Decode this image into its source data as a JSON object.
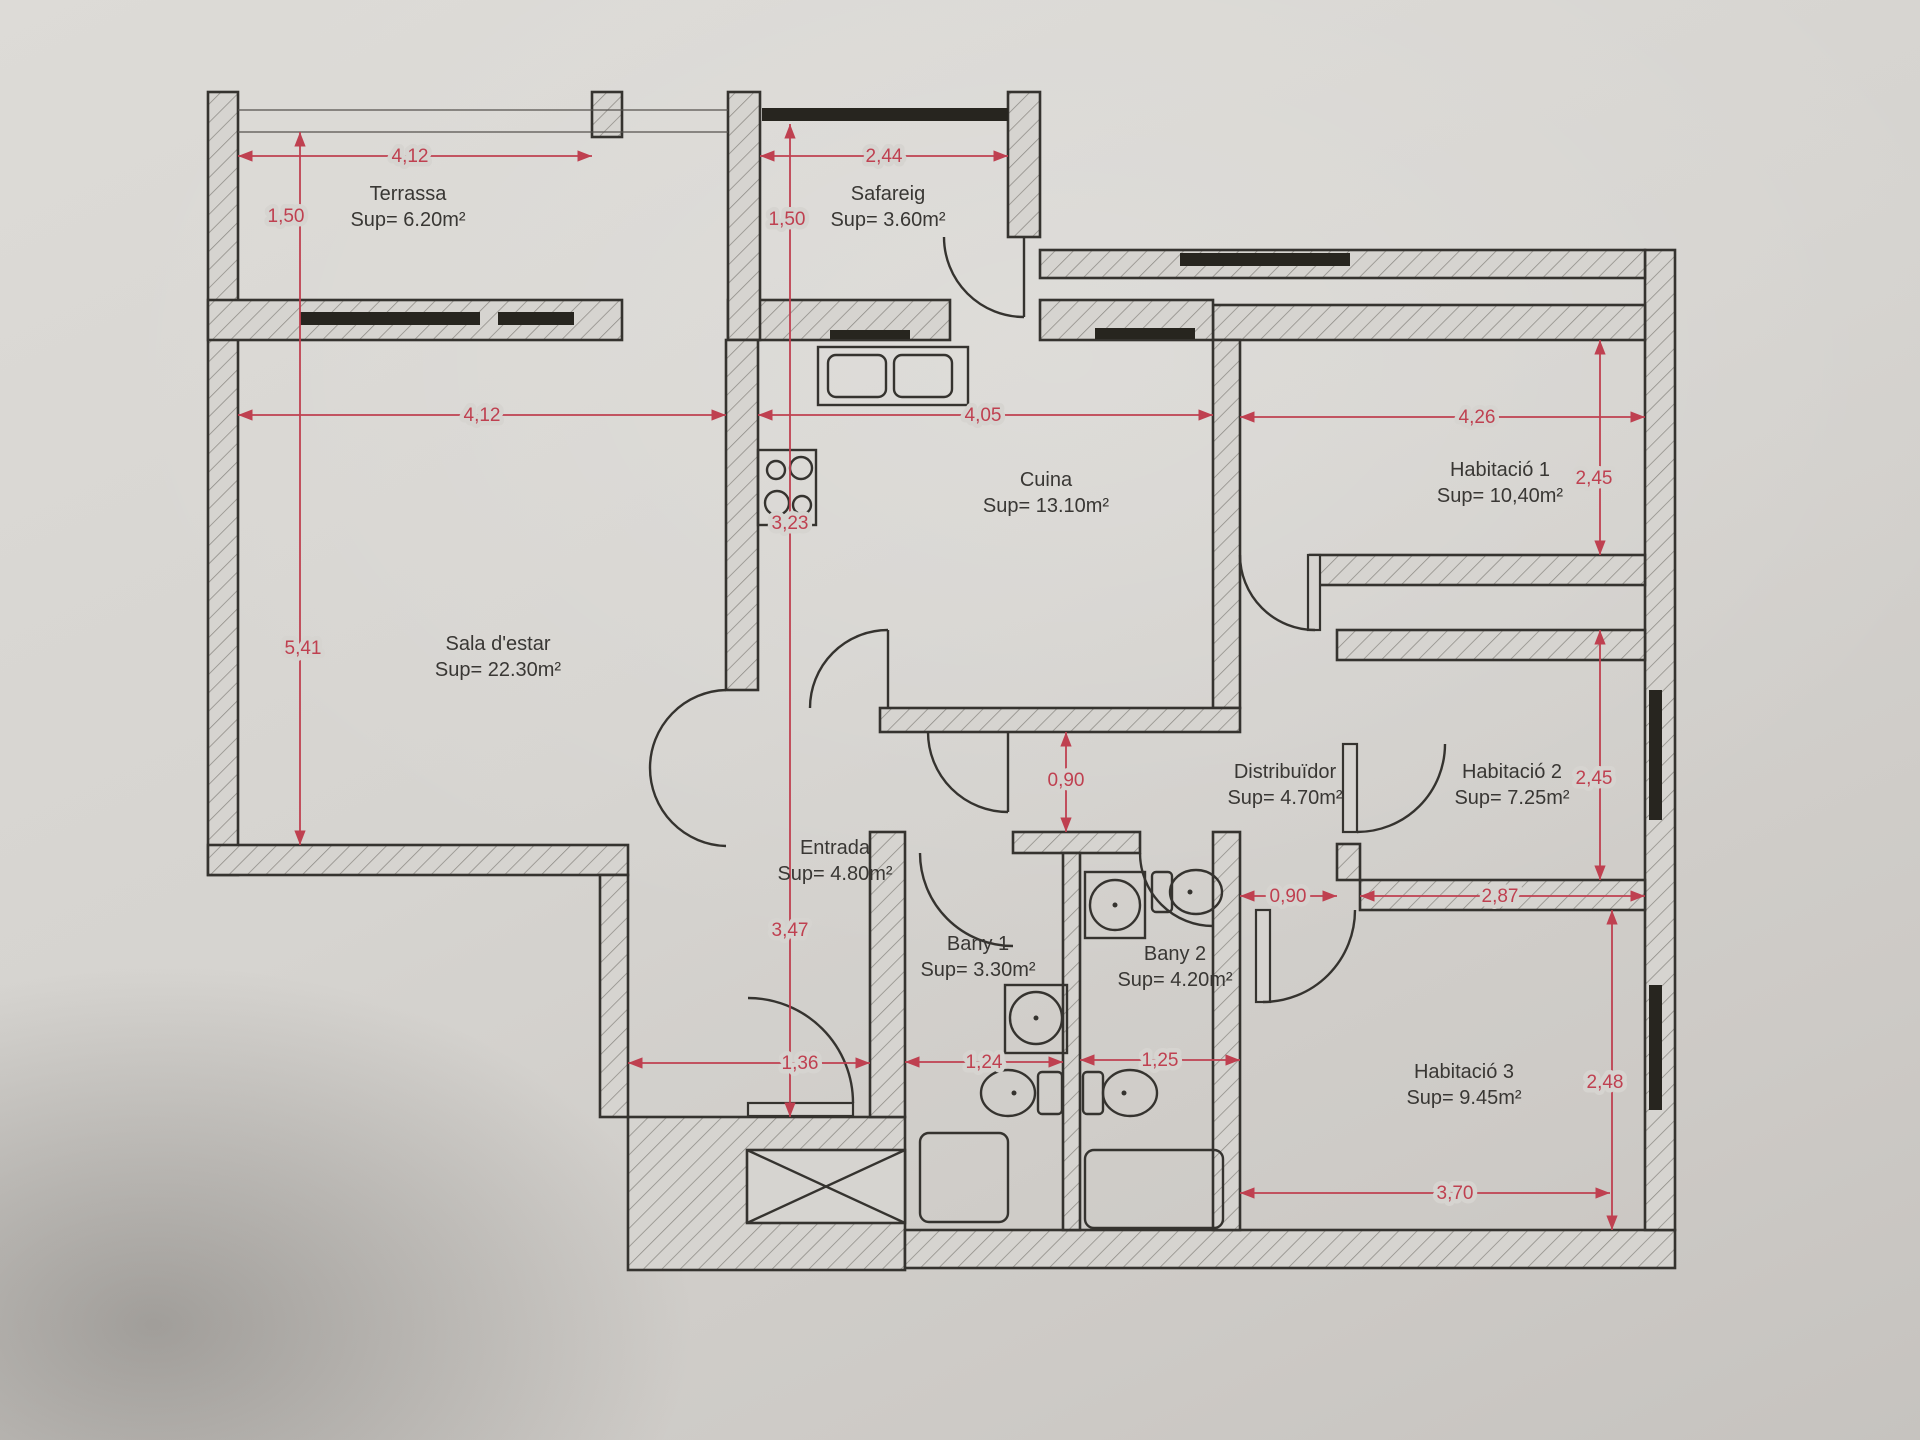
{
  "plan": {
    "rooms": {
      "terrassa": {
        "name": "Terrassa",
        "area": "Sup= 6.20m²"
      },
      "safareig": {
        "name": "Safareig",
        "area": "Sup= 3.60m²"
      },
      "sala": {
        "name": "Sala d'estar",
        "area": "Sup= 22.30m²"
      },
      "cuina": {
        "name": "Cuina",
        "area": "Sup= 13.10m²"
      },
      "hab1": {
        "name": "Habitació 1",
        "area": "Sup= 10,40m²"
      },
      "distribuidor": {
        "name": "Distribuïdor",
        "area": "Sup= 4.70m²"
      },
      "hab2": {
        "name": "Habitació 2",
        "area": "Sup= 7.25m²"
      },
      "entrada": {
        "name": "Entrada",
        "area": "Sup= 4.80m²"
      },
      "bany1": {
        "name": "Bany 1",
        "area": "Sup= 3.30m²"
      },
      "bany2": {
        "name": "Bany 2",
        "area": "Sup= 4.20m²"
      },
      "hab3": {
        "name": "Habitació 3",
        "area": "Sup= 9.45m²"
      }
    },
    "dims": {
      "terrassa_width": "4,12",
      "terrassa_depth": "1,50",
      "safareig_width": "2,44",
      "safareig_depth": "1,50",
      "sala_width": "4,12",
      "sala_height": "5,41",
      "cuina_width": "4,05",
      "cuina_height": "3,23",
      "hab1_width": "4,26",
      "hab1_height": "2,45",
      "corridor_width": "0,90",
      "hab2_width": "2,87",
      "hab2_height": "2,45",
      "distribuidor_pass": "0,90",
      "entrada_height": "3,47",
      "entrada_width": "1,36",
      "bany1_width": "1,24",
      "bany2_width": "1,25",
      "hab3_width": "3,70",
      "hab3_height": "2,48"
    },
    "colors": {
      "dimension_red": "#bf4050",
      "wall_line": "#35332f",
      "paper": "#d6d4d0"
    }
  }
}
